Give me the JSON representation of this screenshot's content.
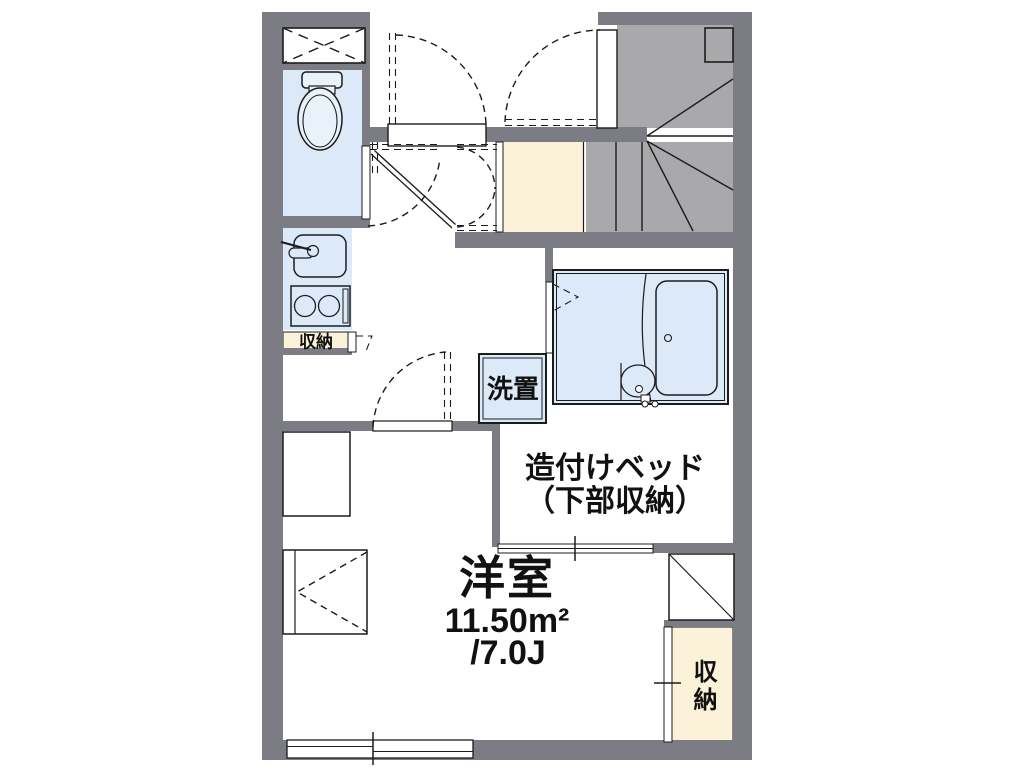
{
  "floorplan": {
    "labels": {
      "room_name": "洋室",
      "room_area_m2": "11.50m²",
      "room_area_jo": "/7.0J",
      "bed_line1": "造付けベッド",
      "bed_line2": "（下部収納）",
      "laundry": "洗置",
      "kitchen_storage": "収納",
      "closet": "収納"
    },
    "fixtures": [
      "toilet",
      "kitchen-sink",
      "two-burner-stove",
      "bathtub",
      "washbasin",
      "winder-staircase",
      "built-in-bed",
      "sliding-window",
      "entrance-doors"
    ],
    "colors": {
      "wall": "#7c7c85",
      "stair": "#a9a9ab",
      "water": "#dce9f8",
      "fixture": "#e9f1fb",
      "beige": "#fcf2da",
      "line": "#1c1c1c",
      "background": "#ffffff"
    }
  }
}
